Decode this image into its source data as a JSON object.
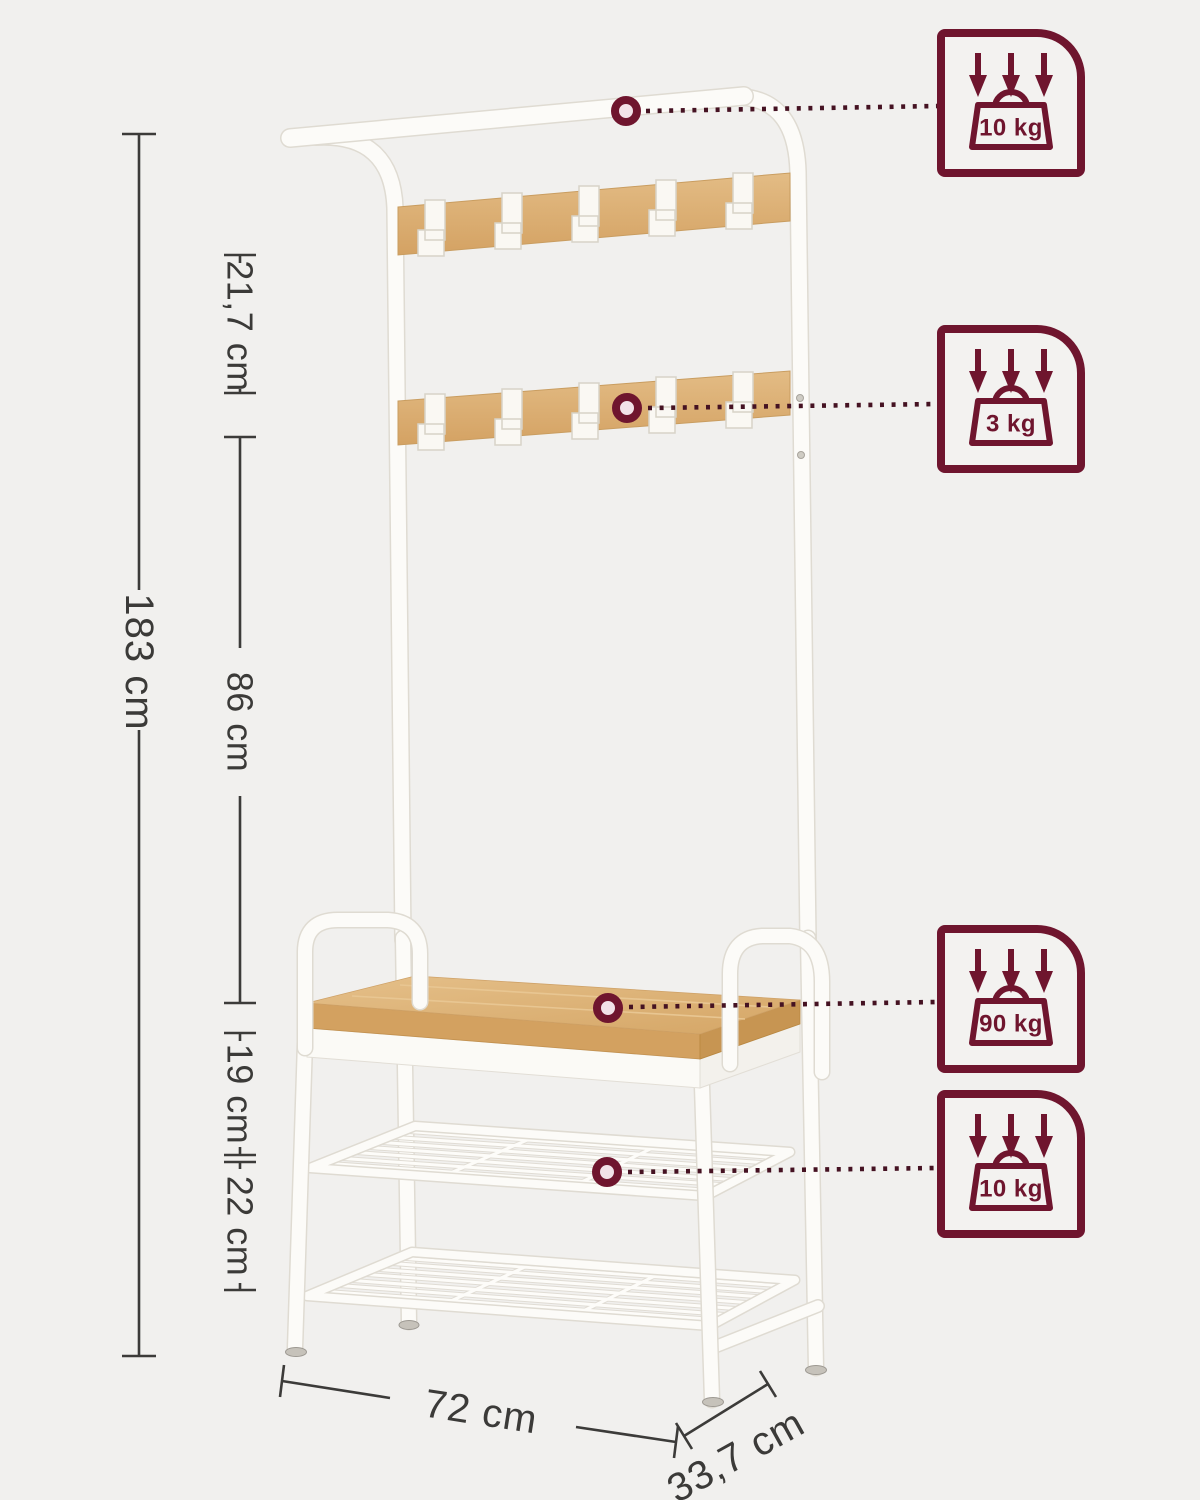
{
  "colors": {
    "background": "#f1f0ee",
    "accent_maroon": "#6f152e",
    "leader_dots": "#451222",
    "wood": "#dcae72",
    "frame_white": "#fcfbf8",
    "dimension_text": "#3b3a38"
  },
  "product": {
    "name": "coat-rack-shoe-bench-dimension-diagram"
  },
  "dimensions": {
    "total_height": "183 cm",
    "top_to_lower_hook_rail": "21,7 cm",
    "hook_rail_to_bench": "86 cm",
    "bench_to_mesh_shelf": "19 cm",
    "mesh_shelf_gap": "22 cm",
    "width": "72 cm",
    "depth": "33,7 cm"
  },
  "load_badges": [
    {
      "part": "top-shelf",
      "label": "10 kg"
    },
    {
      "part": "lower-hook-rail",
      "label": "3 kg"
    },
    {
      "part": "bench-seat",
      "label": "90 kg"
    },
    {
      "part": "mesh-shelf",
      "label": "10 kg"
    }
  ]
}
